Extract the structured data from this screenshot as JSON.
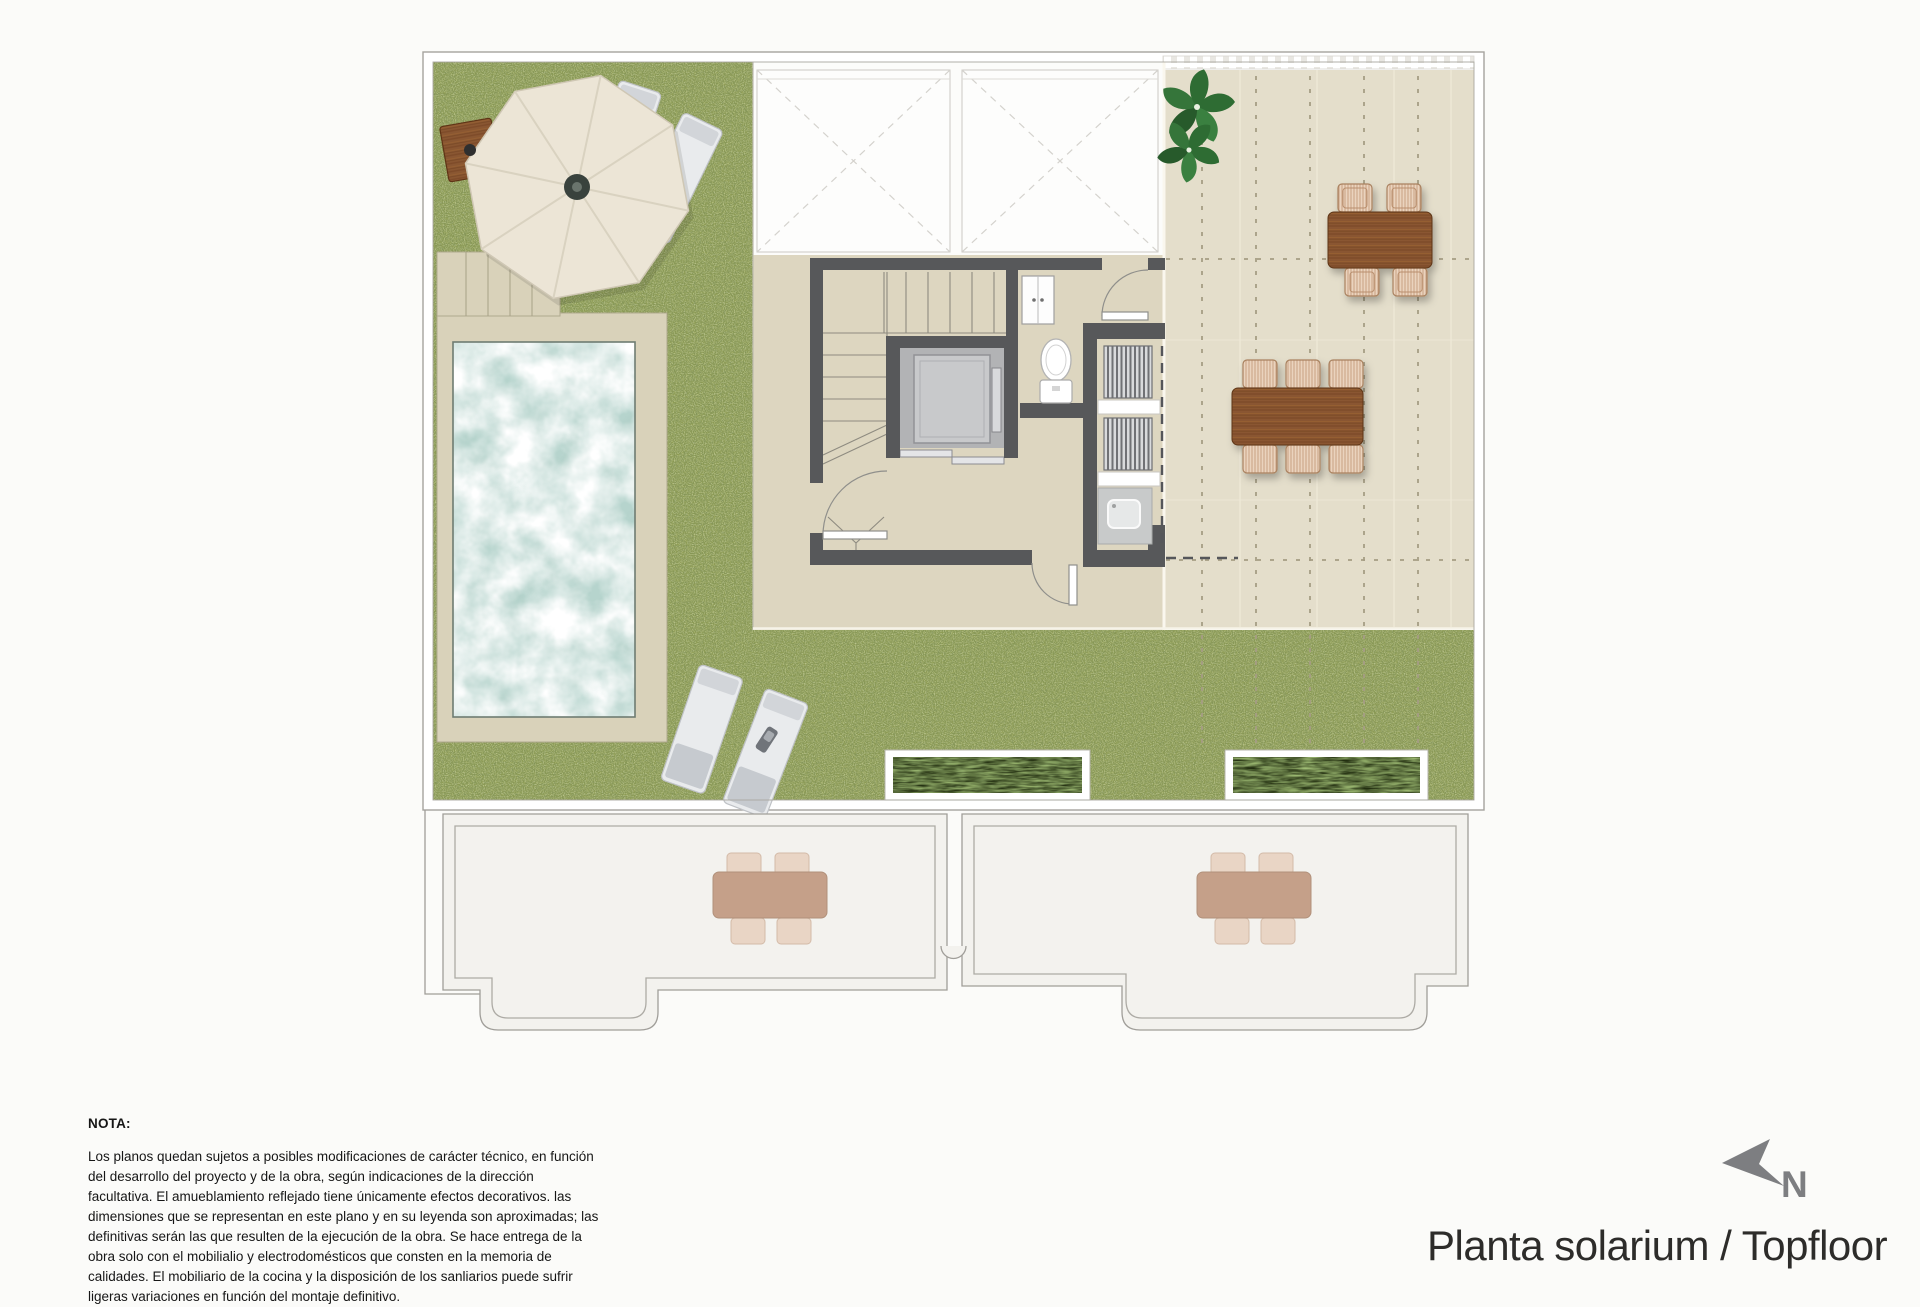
{
  "title": {
    "text": "Planta solarium / Topfloor"
  },
  "compass": {
    "label": "N"
  },
  "note": {
    "heading": "NOTA:",
    "body": "Los planos quedan sujetos a posibles modificaciones de carácter técnico, en función del desarrollo del proyecto y de la obra, según indicaciones de la dirección facultativa. El amueblamiento reflejado tiene únicamente efectos decorativos. las dimensiones que se representan en este plano y en su leyenda son aproximadas; las definitivas serán las que resulten de la ejecución de la obra. Se hace entrega de la obra solo con el mobilialio y electrodomésticos que consten en la memoria de calidades. El mobiliario de la cocina y la disposición de los sanliarios puede sufrir ligeras variaciones en función del montaje definitivo."
  },
  "plan": {
    "floor_name": "Planta solarium / Topfloor",
    "colors": {
      "grass": "#8f9d53",
      "water": "#b6d4cd",
      "pool_deck": "#d9d2ba",
      "center_floor": "#ddd6c0",
      "terrace": "#e4decb",
      "wall": "#57585a",
      "wood": "#8a5732",
      "wicker": "#ead3be",
      "lower_roof": "#f3f2ee",
      "outline": "#9c9b97",
      "north_gray": "#7d7e81"
    },
    "elements": [
      "sun-umbrella",
      "umbrella-wood-base",
      "sun-loungers",
      "swimming-pool",
      "pool-deck",
      "pool-steps",
      "lawn",
      "staircase",
      "elevator",
      "toilet",
      "wc-cabinet",
      "laundry-appliances",
      "laundry-sink",
      "terrace-pergola",
      "dining-table-4-seats",
      "dining-table-6-seats",
      "planter-boxes",
      "potted-plants",
      "lower-roof-terraces",
      "lower-dining-sets",
      "skylight-voids",
      "door-swings",
      "north-arrow"
    ]
  }
}
